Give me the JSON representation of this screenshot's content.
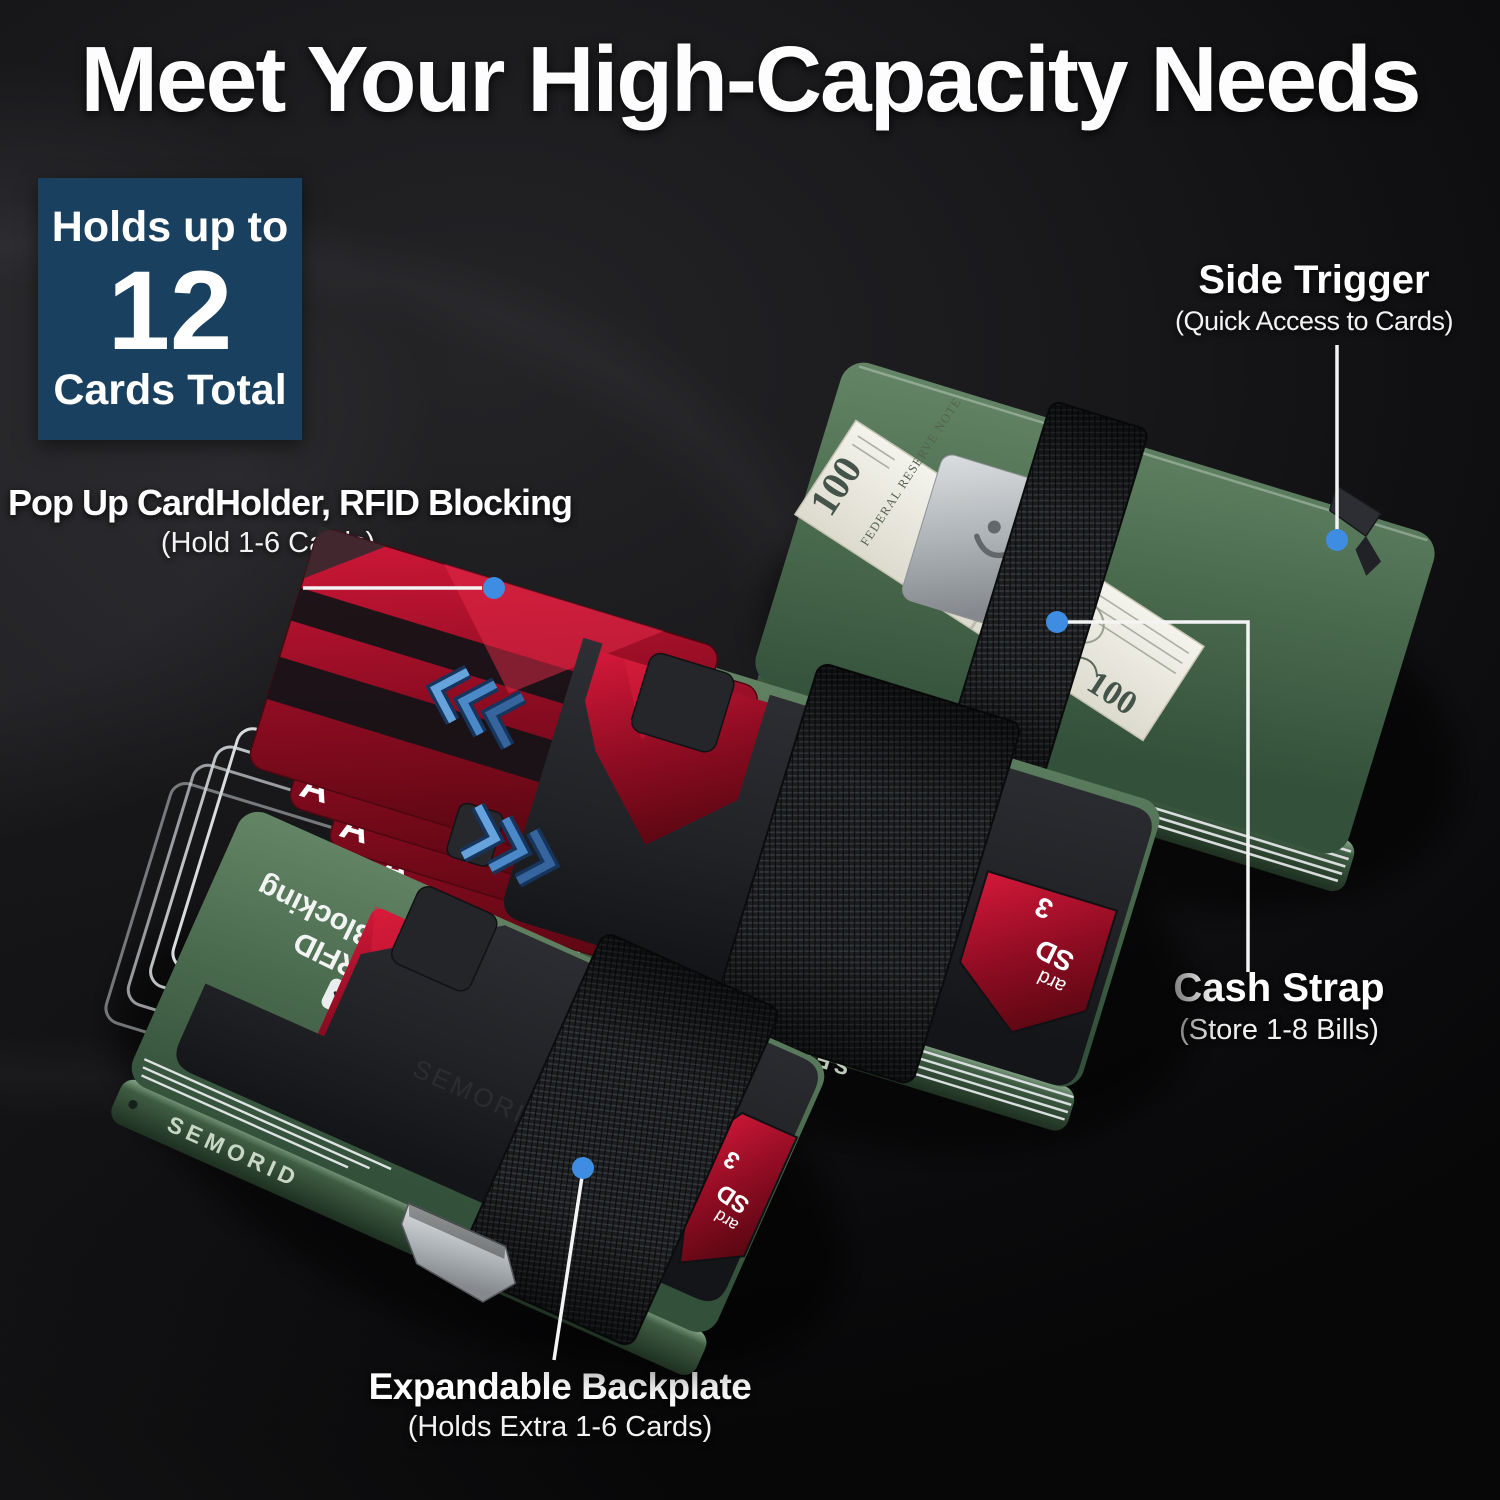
{
  "title": "Meet Your High-Capacity Needs",
  "badge": {
    "line1": "Holds up to",
    "number": "12",
    "line2": "Cards Total"
  },
  "callouts": {
    "pop_up_cardholder": {
      "label": "Pop Up CardHolder, RFID Blocking",
      "sublabel": "(Hold 1-6 Cards)"
    },
    "side_trigger": {
      "label": "Side Trigger",
      "sublabel": "(Quick Access to Cards)"
    },
    "cash_strap": {
      "label": "Cash Strap",
      "sublabel": "(Store 1-8 Bills)"
    },
    "expandable_backplate": {
      "label": "Expandable Backplate",
      "sublabel": "(Holds Extra 1-6 Cards)"
    }
  },
  "product": {
    "brand": "SEMORID",
    "rfid_line1": "RFID",
    "rfid_line2": "Blocking",
    "card_letter": "A",
    "bill_micro_text": "FEDERAL RESERVE NOTE",
    "bill_denomination": "100",
    "card_fragment_1": "ard",
    "card_fragment_2": "SD",
    "card_fragment_3": "3"
  },
  "colors": {
    "badge_navy": "#1a4060",
    "accent_blue": "#3f8de2",
    "wallet_green": "#4d6b50",
    "card_red": "#a51527",
    "strap_black": "#1b1d1f",
    "callout_line": "#f4f4f4"
  }
}
